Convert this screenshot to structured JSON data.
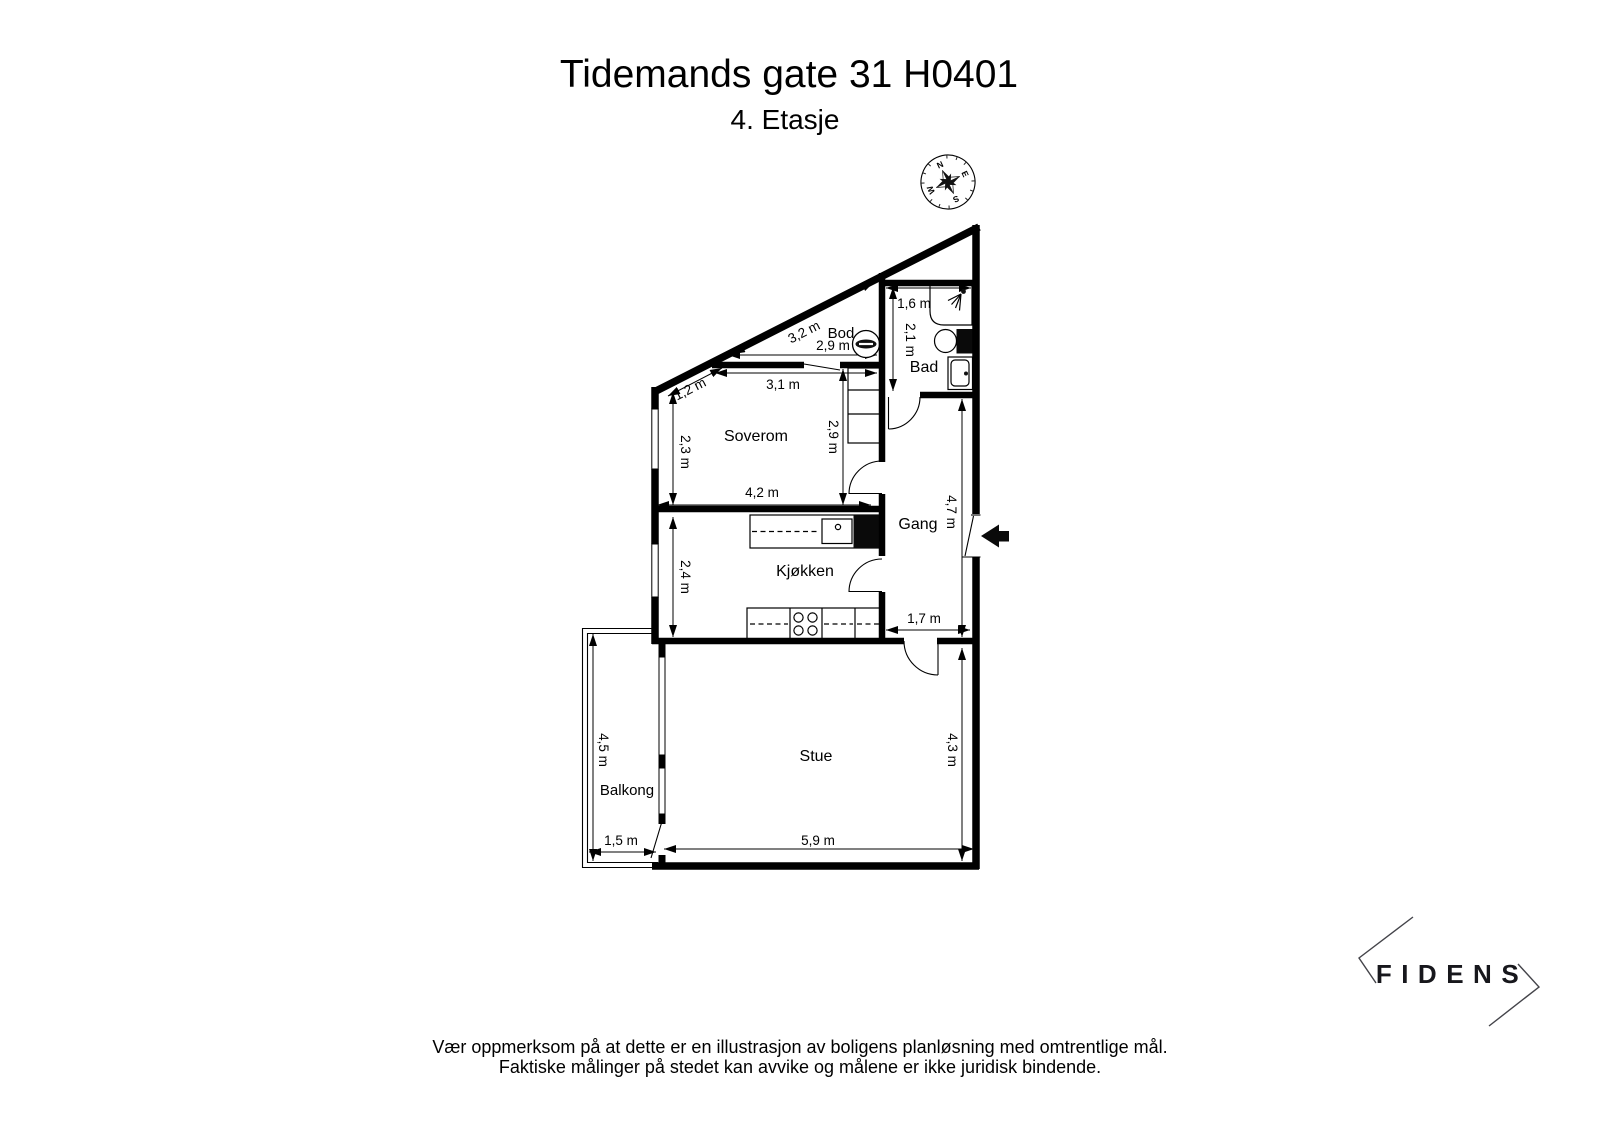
{
  "header": {
    "title": "Tidemands gate 31 H0401",
    "subtitle": "4. Etasje"
  },
  "rooms": {
    "bod": "Bod",
    "bad": "Bad",
    "soverom": "Soverom",
    "gang": "Gang",
    "kjokken": "Kjøkken",
    "stue": "Stue",
    "balkong": "Balkong"
  },
  "dimensions": {
    "bod_diagonal": "3,2 m",
    "bod_width": "2,9 m",
    "bad_width": "1,6 m",
    "bad_height": "2,1 m",
    "soverom_slant": "1,2 m",
    "soverom_top": "3,1 m",
    "soverom_left": "2,3 m",
    "soverom_right": "2,9 m",
    "soverom_bottom": "4,2 m",
    "kjokken_left": "2,4 m",
    "gang_width": "1,7 m",
    "gang_height": "4,7 m",
    "stue_right": "4,3 m",
    "stue_bottom": "5,9 m",
    "balkong_left": "4,5 m",
    "balkong_bottom": "1,5 m"
  },
  "compass": {
    "north": "N",
    "east": "E",
    "south": "S",
    "west": "W"
  },
  "icons": {
    "compass": "compass-rose",
    "entrance_arrow": "solid-left-arrow",
    "washing_machine": "circle-with-slot",
    "shower": "shower-spray",
    "toilet": "toilet-bowl-with-cistern",
    "sink": "wash-basin",
    "stove": "four-burner-cooktop",
    "fridge": "black-appliance-block"
  },
  "branding": {
    "logo_text": "FIDENS"
  },
  "disclaimer": {
    "line1": "Vær oppmerksom på at dette er en illustrasjon av boligens planløsning med omtrentlige mål.",
    "line2": "Faktiske målinger på stedet kan avvike og målene er ikke juridisk bindende."
  }
}
